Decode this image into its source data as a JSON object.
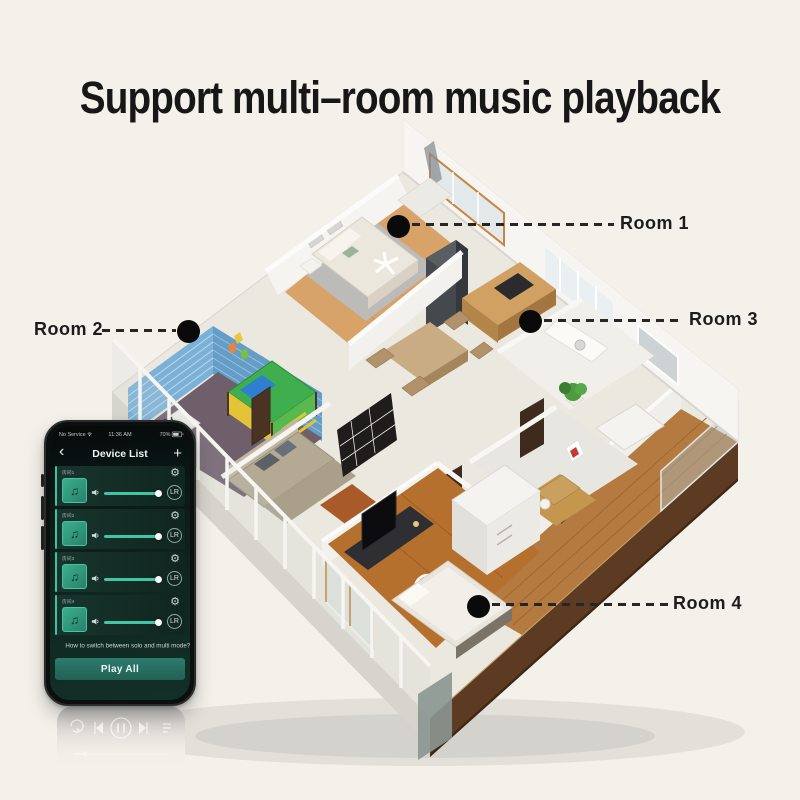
{
  "page": {
    "title": "Support multi–room music playback",
    "background": "#f4f1ea"
  },
  "floorplan": {
    "rooms": [
      {
        "id": "room-1",
        "label": "Room 1"
      },
      {
        "id": "room-2",
        "label": "Room 2"
      },
      {
        "id": "room-3",
        "label": "Room 3"
      },
      {
        "id": "room-4",
        "label": "Room 4"
      }
    ]
  },
  "phone": {
    "status": {
      "carrier": "No Service",
      "time": "11:36 AM",
      "battery": "70%"
    },
    "nav": {
      "title": "Device List"
    },
    "icons": {
      "back": "‹",
      "add": "+",
      "gear": "⚙",
      "note": "♫",
      "channel": "LR",
      "wifi": "wifi-icon",
      "battery": "battery-icon",
      "volume": "speaker-icon"
    },
    "devices": [
      {
        "name": "房间1",
        "volume": 0.92
      },
      {
        "name": "房间2",
        "volume": 0.92
      },
      {
        "name": "房间3",
        "volume": 0.92
      },
      {
        "name": "房间4",
        "volume": 0.92
      }
    ],
    "hint": "How to switch between solo and multi mode?",
    "play_all": "Play All"
  },
  "colors": {
    "accent": "#3fc2a0",
    "phone_screen": "#0f241f",
    "play_all_bg": "#2d7b6d",
    "callout": "#262626",
    "marker": "#0a0a0a",
    "background": "#f4f1ea",
    "room4_wood": "#b5702e",
    "balcony_wood": "#b47a3f",
    "fascia": "#5d3a22",
    "kids_wall_blue": "#7cb1d7",
    "bedroom_wood": "#d7a368"
  }
}
